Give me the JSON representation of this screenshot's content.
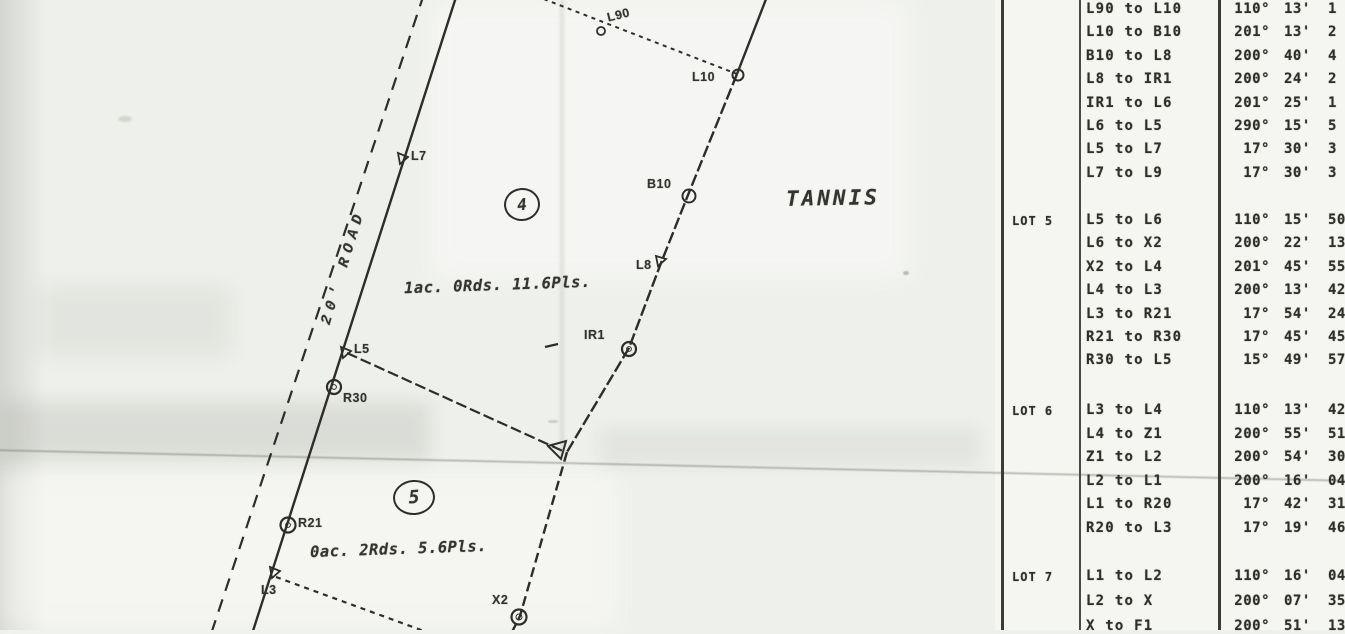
{
  "map": {
    "road_label": "20' ROAD",
    "region_label": "TANNIS",
    "lot4": {
      "number": "4",
      "area": "1ac. 0Rds. 11.6Pls."
    },
    "lot5": {
      "number": "5",
      "area": "0ac. 2Rds. 5.6Pls."
    },
    "points": {
      "l90": "L90",
      "l10": "L10",
      "b10": "B10",
      "l8": "L8",
      "ir1": "IR1",
      "l7": "L7",
      "l5": "L5",
      "r30": "R30",
      "r21": "R21",
      "l3": "L3",
      "x2": "X2"
    }
  },
  "table": {
    "groups": [
      {
        "lot": "",
        "rows": [
          {
            "route": "L90 to L10",
            "deg": "110°",
            "min": "13'",
            "sec": "1"
          },
          {
            "route": "L10 to B10",
            "deg": "201°",
            "min": "13'",
            "sec": "2"
          },
          {
            "route": "B10 to L8",
            "deg": "200°",
            "min": "40'",
            "sec": "4"
          },
          {
            "route": "L8 to IR1",
            "deg": "200°",
            "min": "24'",
            "sec": "2"
          },
          {
            "route": "IR1 to L6",
            "deg": "201°",
            "min": "25'",
            "sec": "1"
          },
          {
            "route": "L6 to L5",
            "deg": "290°",
            "min": "15'",
            "sec": "5"
          },
          {
            "route": "L5 to L7",
            "deg": "17°",
            "min": "30'",
            "sec": "3"
          },
          {
            "route": "L7 to L9",
            "deg": "17°",
            "min": "30'",
            "sec": "3"
          }
        ]
      },
      {
        "lot": "LOT 5",
        "rows": [
          {
            "route": "L5 to L6",
            "deg": "110°",
            "min": "15'",
            "sec": "50"
          },
          {
            "route": "L6 to X2",
            "deg": "200°",
            "min": "22'",
            "sec": "13"
          },
          {
            "route": "X2 to L4",
            "deg": "201°",
            "min": "45'",
            "sec": "55"
          },
          {
            "route": "L4 to L3",
            "deg": "200°",
            "min": "13'",
            "sec": "42"
          },
          {
            "route": "L3 to R21",
            "deg": "17°",
            "min": "54'",
            "sec": "24"
          },
          {
            "route": "R21 to R30",
            "deg": "17°",
            "min": "45'",
            "sec": "45"
          },
          {
            "route": "R30 to L5",
            "deg": "15°",
            "min": "49'",
            "sec": "57"
          }
        ]
      },
      {
        "lot": "LOT 6",
        "rows": [
          {
            "route": "L3 to L4",
            "deg": "110°",
            "min": "13'",
            "sec": "42"
          },
          {
            "route": "L4 to Z1",
            "deg": "200°",
            "min": "55'",
            "sec": "51"
          },
          {
            "route": "Z1 to L2",
            "deg": "200°",
            "min": "54'",
            "sec": "30"
          },
          {
            "route": "L2 to L1",
            "deg": "200°",
            "min": "16'",
            "sec": "04"
          },
          {
            "route": "L1 to R20",
            "deg": "17°",
            "min": "42'",
            "sec": "31"
          },
          {
            "route": "R20 to L3",
            "deg": "17°",
            "min": "19'",
            "sec": "46"
          }
        ]
      },
      {
        "lot": "LOT 7",
        "rows": [
          {
            "route": "L1 to L2",
            "deg": "110°",
            "min": "16'",
            "sec": "04"
          },
          {
            "route": "L2 to X",
            "deg": "200°",
            "min": "07'",
            "sec": "35"
          },
          {
            "route": "X to F1",
            "deg": "200°",
            "min": "51'",
            "sec": "13"
          }
        ]
      }
    ]
  }
}
